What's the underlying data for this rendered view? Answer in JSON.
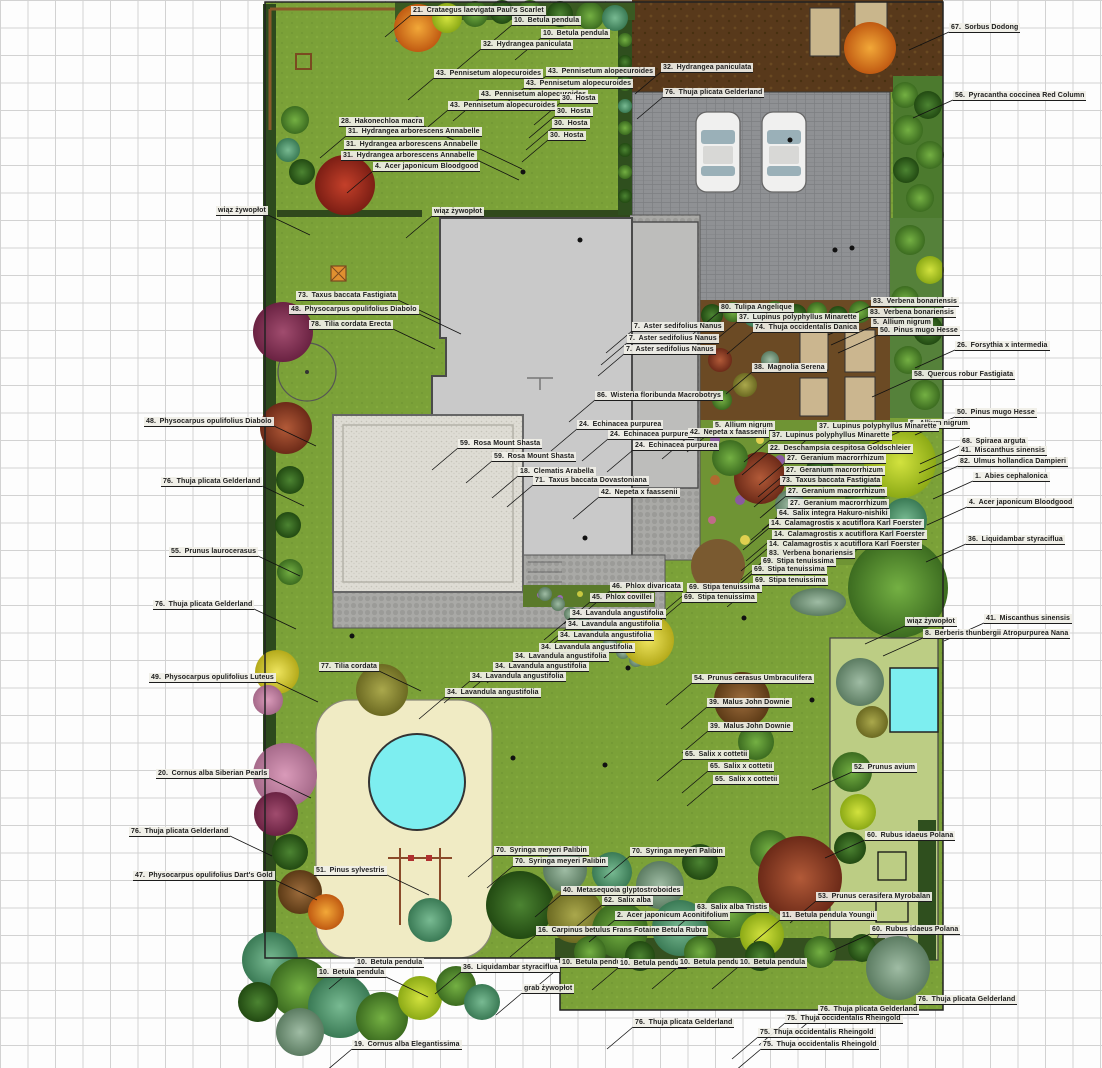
{
  "document": {
    "kind": "residential garden planting plan (top view)"
  },
  "palette": {
    "grid_line": "#d2d2d2",
    "lawn": "#7ba138",
    "front_lawn": "#7fa33c",
    "vegetable_garden": "#bccd84",
    "soil_dark": "#4f3714",
    "bed_soil": "#6b4a24",
    "driveway": "#8f9194",
    "house": "#c9c9c9",
    "patio_gravel": "#dedcd4",
    "sand_play": "#f0ebc4",
    "pool": "#7deef0",
    "hedge_dark": "#2d4a1d",
    "label_bg": "#f0efe7",
    "label_text": "#1c1c1c",
    "leader_line": "#111111"
  },
  "plant_labels": [
    {
      "n": "21",
      "t": "Crataegus laevigata Paul's Scarlet",
      "x": 411,
      "y": 6
    },
    {
      "n": "10",
      "t": "Betula pendula",
      "x": 512,
      "y": 16
    },
    {
      "n": "10",
      "t": "Betula pendula",
      "x": 541,
      "y": 29
    },
    {
      "n": "32",
      "t": "Hydrangea paniculata",
      "x": 481,
      "y": 40
    },
    {
      "n": "43",
      "t": "Pennisetum alopecuroides",
      "x": 546,
      "y": 67
    },
    {
      "n": "43",
      "t": "Pennisetum alopecuroides",
      "x": 434,
      "y": 69
    },
    {
      "n": "43",
      "t": "Pennisetum alopecuroides",
      "x": 524,
      "y": 79
    },
    {
      "n": "43",
      "t": "Pennisetum alopecuroides",
      "x": 479,
      "y": 90
    },
    {
      "n": "43",
      "t": "Pennisetum alopecuroides",
      "x": 448,
      "y": 101
    },
    {
      "n": "30",
      "t": "Hosta",
      "x": 560,
      "y": 94
    },
    {
      "n": "30",
      "t": "Hosta",
      "x": 555,
      "y": 107
    },
    {
      "n": "30",
      "t": "Hosta",
      "x": 552,
      "y": 119
    },
    {
      "n": "30",
      "t": "Hosta",
      "x": 548,
      "y": 131
    },
    {
      "n": "28",
      "t": "Hakonechloa macra",
      "x": 339,
      "y": 117
    },
    {
      "n": "31",
      "t": "Hydrangea arborescens Annabelle",
      "x": 346,
      "y": 127
    },
    {
      "n": "31",
      "t": "Hydrangea arborescens Annabelle",
      "x": 344,
      "y": 140
    },
    {
      "n": "31",
      "t": "Hydrangea arborescens Annabelle",
      "x": 341,
      "y": 151
    },
    {
      "n": "4",
      "t": "Acer japonicum Bloodgood",
      "x": 373,
      "y": 162
    },
    {
      "n": "",
      "t": "wiąz żywopłot",
      "x": 216,
      "y": 206
    },
    {
      "n": "",
      "t": "wiąz żywopłot",
      "x": 432,
      "y": 207
    },
    {
      "n": "67",
      "t": "Sorbus Dodong",
      "x": 949,
      "y": 23
    },
    {
      "n": "32",
      "t": "Hydrangea paniculata",
      "x": 661,
      "y": 63
    },
    {
      "n": "76",
      "t": "Thuja plicata Gelderland",
      "x": 663,
      "y": 88
    },
    {
      "n": "56",
      "t": "Pyracantha coccinea Red Column",
      "x": 953,
      "y": 91
    },
    {
      "n": "73",
      "t": "Taxus baccata Fastigiata",
      "x": 296,
      "y": 291
    },
    {
      "n": "48",
      "t": "Physocarpus opulifolius Diabolo",
      "x": 289,
      "y": 305
    },
    {
      "n": "78",
      "t": "Tilia cordata Erecta",
      "x": 309,
      "y": 320
    },
    {
      "n": "48",
      "t": "Physocarpus opulifolius Diabolo",
      "x": 144,
      "y": 417
    },
    {
      "n": "76",
      "t": "Thuja plicata Gelderland",
      "x": 161,
      "y": 477
    },
    {
      "n": "55",
      "t": "Prunus laurocerasus",
      "x": 169,
      "y": 547
    },
    {
      "n": "76",
      "t": "Thuja plicata Gelderland",
      "x": 153,
      "y": 600
    },
    {
      "n": "49",
      "t": "Physocarpus opulifolius Luteus",
      "x": 149,
      "y": 673
    },
    {
      "n": "77",
      "t": "Tilia cordata",
      "x": 319,
      "y": 662
    },
    {
      "n": "20",
      "t": "Cornus alba Siberian Pearls",
      "x": 156,
      "y": 769
    },
    {
      "n": "76",
      "t": "Thuja plicata Gelderland",
      "x": 129,
      "y": 827
    },
    {
      "n": "47",
      "t": "Physocarpus opulifolius Dart's Gold",
      "x": 133,
      "y": 871
    },
    {
      "n": "51",
      "t": "Pinus sylvestris",
      "x": 314,
      "y": 866
    },
    {
      "n": "80",
      "t": "Tulipa Angelique",
      "x": 719,
      "y": 303
    },
    {
      "n": "37",
      "t": "Lupinus polyphyllus Minarette",
      "x": 737,
      "y": 313
    },
    {
      "n": "74",
      "t": "Thuja occidentalis Danica",
      "x": 753,
      "y": 323
    },
    {
      "n": "83",
      "t": "Verbena bonariensis",
      "x": 871,
      "y": 297
    },
    {
      "n": "83",
      "t": "Verbena bonariensis",
      "x": 868,
      "y": 308
    },
    {
      "n": "5",
      "t": "Allium nigrum",
      "x": 871,
      "y": 318
    },
    {
      "n": "50",
      "t": "Pinus mugo Hesse",
      "x": 878,
      "y": 326
    },
    {
      "n": "7",
      "t": "Aster sedifolius Nanus",
      "x": 632,
      "y": 322
    },
    {
      "n": "7",
      "t": "Aster sedifolius Nanus",
      "x": 627,
      "y": 334
    },
    {
      "n": "7",
      "t": "Aster sedifolius Nanus",
      "x": 624,
      "y": 345
    },
    {
      "n": "38",
      "t": "Magnolia Serena",
      "x": 752,
      "y": 363
    },
    {
      "n": "26",
      "t": "Forsythia x intermedia",
      "x": 955,
      "y": 341
    },
    {
      "n": "58",
      "t": "Quercus robur Fastigiata",
      "x": 912,
      "y": 370
    },
    {
      "n": "86",
      "t": "Wisteria floribunda Macrobotrys",
      "x": 595,
      "y": 391
    },
    {
      "n": "50",
      "t": "Pinus mugo Hesse",
      "x": 955,
      "y": 408
    },
    {
      "n": "5",
      "t": "Allium nigrum",
      "x": 908,
      "y": 419
    },
    {
      "n": "37",
      "t": "Lupinus polyphyllus Minarette",
      "x": 817,
      "y": 422
    },
    {
      "n": "37",
      "t": "Lupinus polyphyllus Minarette",
      "x": 770,
      "y": 431
    },
    {
      "n": "22",
      "t": "Deschampsia cespitosa Goldschleier",
      "x": 768,
      "y": 444
    },
    {
      "n": "27",
      "t": "Geranium macrorrhizum",
      "x": 785,
      "y": 454
    },
    {
      "n": "27",
      "t": "Geranium macrorrhizum",
      "x": 784,
      "y": 466
    },
    {
      "n": "73",
      "t": "Taxus baccata Fastigiata",
      "x": 780,
      "y": 476
    },
    {
      "n": "27",
      "t": "Geranium macrorrhizum",
      "x": 786,
      "y": 487
    },
    {
      "n": "27",
      "t": "Geranium macrorrhizum",
      "x": 788,
      "y": 499
    },
    {
      "n": "64",
      "t": "Salix integra Hakuro-nishiki",
      "x": 777,
      "y": 509
    },
    {
      "n": "14",
      "t": "Calamagrostis x acutiflora Karl Foerster",
      "x": 769,
      "y": 519
    },
    {
      "n": "14",
      "t": "Calamagrostis x acutiflora Karl Foerster",
      "x": 772,
      "y": 530
    },
    {
      "n": "14",
      "t": "Calamagrostis x acutiflora Karl Foerster",
      "x": 767,
      "y": 540
    },
    {
      "n": "83",
      "t": "Verbena bonariensis",
      "x": 767,
      "y": 549
    },
    {
      "n": "69",
      "t": "Stipa tenuissima",
      "x": 761,
      "y": 557
    },
    {
      "n": "69",
      "t": "Stipa tenuissima",
      "x": 752,
      "y": 565
    },
    {
      "n": "69",
      "t": "Stipa tenuissima",
      "x": 753,
      "y": 576
    },
    {
      "n": "69",
      "t": "Stipa tenuissima",
      "x": 687,
      "y": 583
    },
    {
      "n": "69",
      "t": "Stipa tenuissima",
      "x": 682,
      "y": 593
    },
    {
      "n": "68",
      "t": "Spiraea arguta",
      "x": 960,
      "y": 437
    },
    {
      "n": "41",
      "t": "Miscanthus sinensis",
      "x": 959,
      "y": 446
    },
    {
      "n": "82",
      "t": "Ulmus hollandica Dampieri",
      "x": 958,
      "y": 457
    },
    {
      "n": "1",
      "t": "Abies cephalonica",
      "x": 973,
      "y": 472
    },
    {
      "n": "4",
      "t": "Acer japonicum Bloodgood",
      "x": 967,
      "y": 498
    },
    {
      "n": "36",
      "t": "Liquidambar styraciflua",
      "x": 966,
      "y": 535
    },
    {
      "n": "41",
      "t": "Miscanthus sinensis",
      "x": 984,
      "y": 614
    },
    {
      "n": "",
      "t": "wiąz żywopłot",
      "x": 905,
      "y": 617
    },
    {
      "n": "8",
      "t": "Berberis thunbergii Atropurpurea Nana",
      "x": 923,
      "y": 629
    },
    {
      "n": "59",
      "t": "Rosa Mount Shasta",
      "x": 458,
      "y": 439
    },
    {
      "n": "59",
      "t": "Rosa Mount Shasta",
      "x": 492,
      "y": 452
    },
    {
      "n": "18",
      "t": "Clematis Arabella",
      "x": 518,
      "y": 467
    },
    {
      "n": "71",
      "t": "Taxus baccata Dovastoniana",
      "x": 533,
      "y": 476
    },
    {
      "n": "42",
      "t": "Nepeta x faassenii",
      "x": 599,
      "y": 488
    },
    {
      "n": "24",
      "t": "Echinacea purpurea",
      "x": 577,
      "y": 420
    },
    {
      "n": "24",
      "t": "Echinacea purpurea",
      "x": 608,
      "y": 430
    },
    {
      "n": "24",
      "t": "Echinacea purpurea",
      "x": 633,
      "y": 441
    },
    {
      "n": "5",
      "t": "Allium nigrum",
      "x": 713,
      "y": 421
    },
    {
      "n": "42",
      "t": "Nepeta x faassenii",
      "x": 688,
      "y": 428
    },
    {
      "n": "46",
      "t": "Phlox divaricata",
      "x": 610,
      "y": 582
    },
    {
      "n": "45",
      "t": "Phlox covillei",
      "x": 590,
      "y": 593
    },
    {
      "n": "34",
      "t": "Lavandula angustifolia",
      "x": 570,
      "y": 609
    },
    {
      "n": "34",
      "t": "Lavandula angustifolia",
      "x": 566,
      "y": 620
    },
    {
      "n": "34",
      "t": "Lavandula angustifolia",
      "x": 558,
      "y": 631
    },
    {
      "n": "34",
      "t": "Lavandula angustifolia",
      "x": 539,
      "y": 643
    },
    {
      "n": "34",
      "t": "Lavandula angustifolia",
      "x": 513,
      "y": 652
    },
    {
      "n": "34",
      "t": "Lavandula angustifolia",
      "x": 493,
      "y": 662
    },
    {
      "n": "34",
      "t": "Lavandula angustifolia",
      "x": 470,
      "y": 672
    },
    {
      "n": "34",
      "t": "Lavandula angustifolia",
      "x": 445,
      "y": 688
    },
    {
      "n": "54",
      "t": "Prunus cerasus Umbraculifera",
      "x": 692,
      "y": 674
    },
    {
      "n": "39",
      "t": "Malus John Downie",
      "x": 707,
      "y": 698
    },
    {
      "n": "39",
      "t": "Malus John Downie",
      "x": 708,
      "y": 722
    },
    {
      "n": "65",
      "t": "Salix x cottetii",
      "x": 683,
      "y": 750
    },
    {
      "n": "65",
      "t": "Salix x cottetii",
      "x": 708,
      "y": 762
    },
    {
      "n": "65",
      "t": "Salix x cottetii",
      "x": 713,
      "y": 775
    },
    {
      "n": "52",
      "t": "Prunus avium",
      "x": 852,
      "y": 763
    },
    {
      "n": "60",
      "t": "Rubus idaeus Polana",
      "x": 865,
      "y": 831
    },
    {
      "n": "53",
      "t": "Prunus cerasifera Myrobalan",
      "x": 816,
      "y": 892
    },
    {
      "n": "11",
      "t": "Betula pendula Youngii",
      "x": 780,
      "y": 911
    },
    {
      "n": "60",
      "t": "Rubus idaeus Polana",
      "x": 870,
      "y": 925
    },
    {
      "n": "70",
      "t": "Syringa meyeri Palibin",
      "x": 494,
      "y": 846
    },
    {
      "n": "70",
      "t": "Syringa meyeri Palibin",
      "x": 513,
      "y": 857
    },
    {
      "n": "70",
      "t": "Syringa meyeri Palibin",
      "x": 630,
      "y": 847
    },
    {
      "n": "40",
      "t": "Metasequoia glyptostroboides",
      "x": 561,
      "y": 886
    },
    {
      "n": "62",
      "t": "Salix alba",
      "x": 602,
      "y": 896
    },
    {
      "n": "63",
      "t": "Salix alba Tristis",
      "x": 695,
      "y": 903
    },
    {
      "n": "2",
      "t": "Acer japonicum Aconitifolium",
      "x": 615,
      "y": 911
    },
    {
      "n": "16",
      "t": "Carpinus betulus Frans Fotaine  Betula Rubra",
      "x": 536,
      "y": 926
    },
    {
      "n": "10",
      "t": "Betula pendula",
      "x": 355,
      "y": 958
    },
    {
      "n": "10",
      "t": "Betula pendula",
      "x": 317,
      "y": 968
    },
    {
      "n": "36",
      "t": "Liquidambar styraciflua",
      "x": 461,
      "y": 963
    },
    {
      "n": "10",
      "t": "Betula pendula",
      "x": 560,
      "y": 958
    },
    {
      "n": "10",
      "t": "Betula pendula",
      "x": 618,
      "y": 959
    },
    {
      "n": "10",
      "t": "Betula pendula",
      "x": 678,
      "y": 958
    },
    {
      "n": "10",
      "t": "Betula pendula",
      "x": 738,
      "y": 958
    },
    {
      "n": "",
      "t": "grab żywopłot",
      "x": 522,
      "y": 984
    },
    {
      "n": "76",
      "t": "Thuja plicata Gelderland",
      "x": 633,
      "y": 1018
    },
    {
      "n": "75",
      "t": "Thuja occidentalis Rheingold",
      "x": 785,
      "y": 1014
    },
    {
      "n": "75",
      "t": "Thuja occidentalis Rheingold",
      "x": 758,
      "y": 1028
    },
    {
      "n": "75",
      "t": "Thuja occidentalis Rheingold",
      "x": 761,
      "y": 1040
    },
    {
      "n": "76",
      "t": "Thuja plicata Gelderland",
      "x": 818,
      "y": 1005
    },
    {
      "n": "76",
      "t": "Thuja plicata Gelderland",
      "x": 916,
      "y": 995
    },
    {
      "n": "19",
      "t": "Cornus alba Elegantissima",
      "x": 352,
      "y": 1040
    }
  ]
}
